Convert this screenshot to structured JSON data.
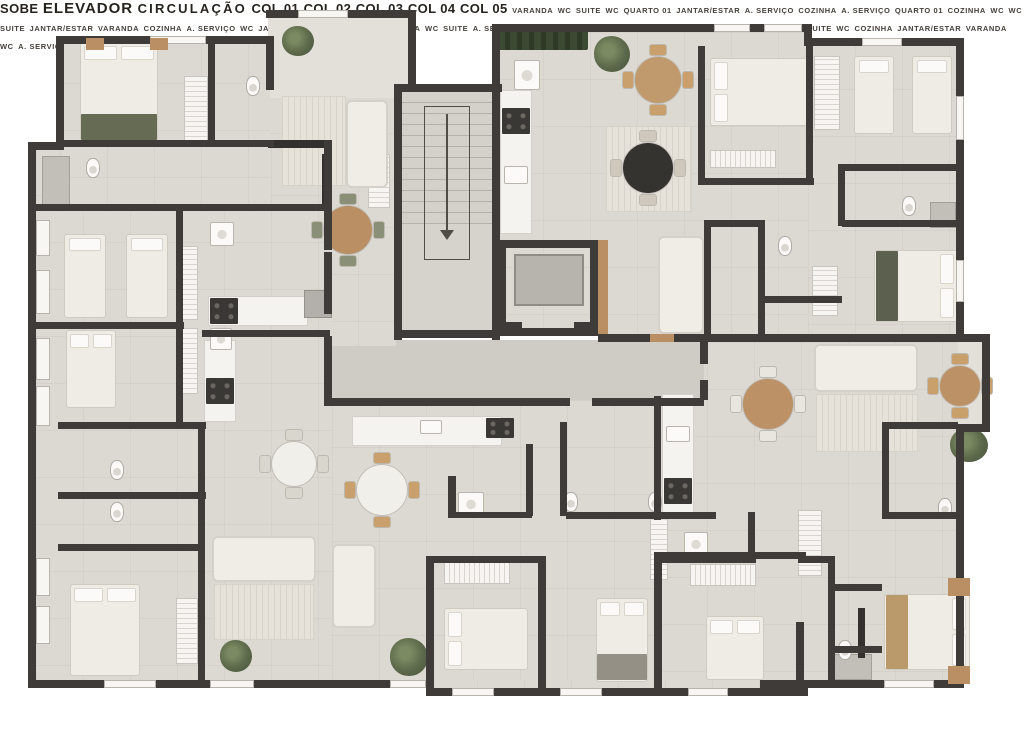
{
  "plan": {
    "title": "Floor plan",
    "core": {
      "sobe": "SOBE",
      "elevador": "ELEVADOR",
      "circulacao": "CIRCULAÇÃO"
    },
    "units": {
      "col01": {
        "name": "COL 01",
        "rooms": {
          "servico": "A. SERVIÇO",
          "varanda": "VARANDA",
          "cozinha": "COZINHA",
          "jantar": "JANTAR/ESTAR",
          "quarto1": "QUARTO 01",
          "quarto2": "QUARTO 02",
          "wc": "WC",
          "suite": "SUITE",
          "wc_suite": "WC"
        }
      },
      "col02": {
        "name": "COL 02",
        "rooms": {
          "cozinha": "COZINHA",
          "jantar": "JANTAR/ESTAR",
          "varanda": "VARANDA",
          "wc": "WC",
          "servico": "A. SERVIÇO",
          "suite": "SUITE",
          "quarto1": "QUARTO 01",
          "wc_suite": "WC"
        }
      },
      "col03": {
        "name": "COL 03",
        "rooms": {
          "cozinha": "COZINHA",
          "servico": "A. SERVIÇO",
          "wc": "WC",
          "jantar": "JANTAR/ESTAR",
          "quarto1": "QUARTO 01",
          "varanda": "VARANDA",
          "wc_suite": "WC",
          "suite": "SUITE"
        }
      },
      "col04": {
        "name": "COL 04",
        "rooms": {
          "servico": "A. SERVIÇO",
          "quarto1": "QUARTO 01",
          "cozinha": "COZINHA",
          "wc": "WC",
          "wc2": "WC",
          "suite": "SUITE",
          "jantar": "JANTAR/ESTAR",
          "varanda": "VARANDA"
        }
      },
      "col05": {
        "name": "COL 05",
        "rooms": {
          "varanda": "VARANDA",
          "wc": "WC",
          "suite": "SUITE",
          "wc2": "WC",
          "quarto1": "QUARTO 01",
          "jantar": "JANTAR/ESTAR",
          "servico": "A. SERVIÇO",
          "cozinha": "COZINHA"
        }
      }
    }
  },
  "palette": {
    "wall": "#3e3b39",
    "floor": "#dcd8d2",
    "floor_corridor": "#cfccc5",
    "floor_varanda": "#e3e0da",
    "floor_core": "#d6d3cd",
    "wood": "#b98f63",
    "counter": "#f4f3f0",
    "plant": "#5f6b4c",
    "text": "#44403b"
  }
}
